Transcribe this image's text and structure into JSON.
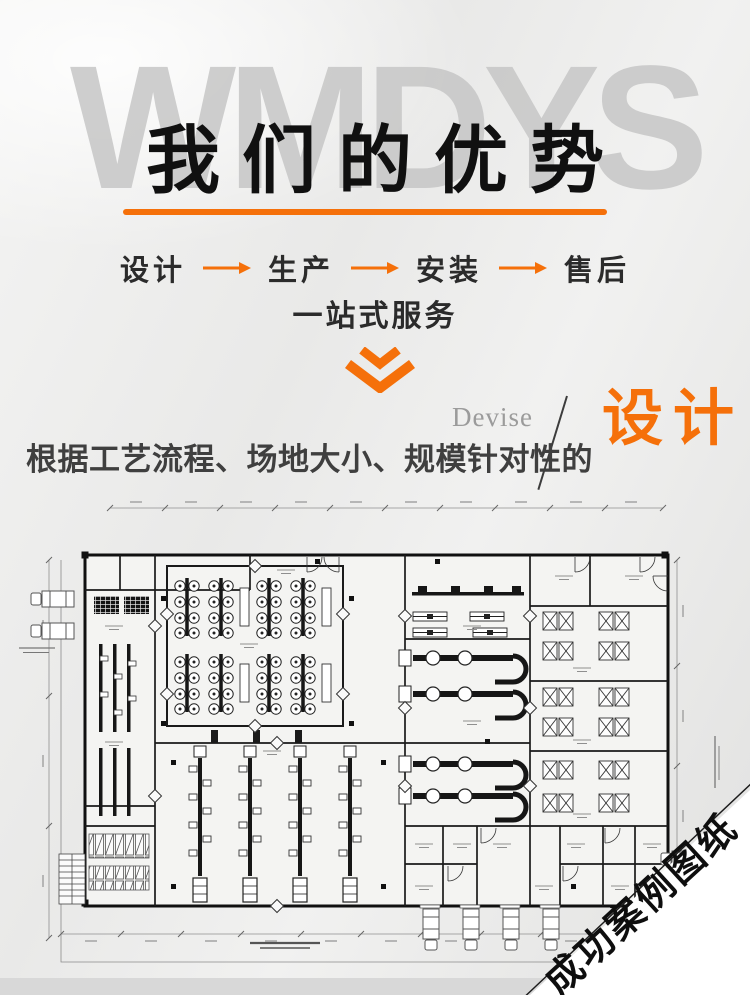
{
  "watermark": {
    "text": "WMDYS"
  },
  "header": {
    "title": "我们的优势"
  },
  "process": {
    "steps": [
      "设计",
      "生产",
      "安装",
      "售后"
    ],
    "subtitle": "一站式服务"
  },
  "design_section": {
    "eyebrow": "Devise",
    "keyword": "设计",
    "description": "根据工艺流程、场地大小、规模针对性的"
  },
  "floorplan": {
    "corner_banner": "成功案例图纸"
  },
  "icons": {
    "flow_arrow": "arrow-right",
    "section_divider": "double-chevron-down"
  },
  "colors": {
    "accent": "#f5700a",
    "title_ink": "#101010",
    "watermark_gray": "#c5c5c5",
    "banner_bg": "#ffffff"
  }
}
